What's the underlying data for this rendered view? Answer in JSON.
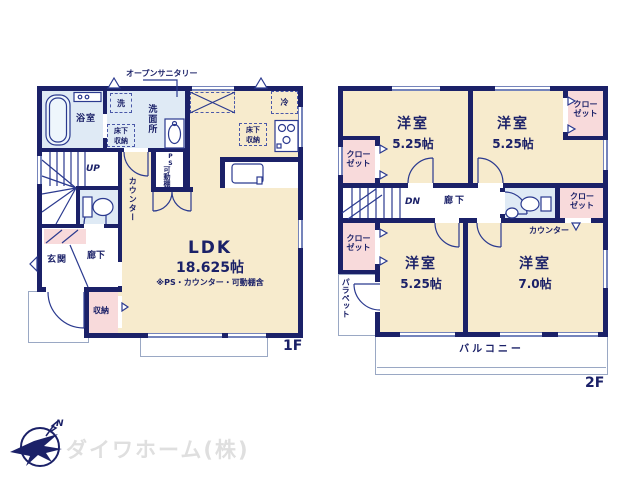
{
  "colors": {
    "wall": "#1b2168",
    "room_cream": "#f7ebcd",
    "closet_pink": "#f8dadb",
    "wet_blue": "#dfeaf5",
    "line": "#2b3a8f",
    "logo_text": "#dfdfdf"
  },
  "floor1": {
    "floor_label": "1F",
    "open_sanitary": "オープンサニタリー",
    "bath": "浴室",
    "washer": "洗",
    "washroom": "洗面所",
    "underfloor_storage_wash": "床下収納",
    "underfloor_storage_kitchen": "床下収納",
    "fridge": "冷",
    "stairs_up": "UP",
    "counter": "カウンター",
    "pipe_space": "PS",
    "movable_shelf": "可動棚",
    "entrance": "玄関",
    "hallway": "廊下",
    "storage": "収納",
    "ldk_name": "LDK",
    "ldk_size": "18.625帖",
    "ldk_note": "※PS・カウンター・可動棚含"
  },
  "floor2": {
    "floor_label": "2F",
    "bedrooms": [
      {
        "name": "洋室",
        "size": "5.25帖"
      },
      {
        "name": "洋室",
        "size": "5.25帖"
      },
      {
        "name": "洋室",
        "size": "5.25帖"
      },
      {
        "name": "洋室",
        "size": "7.0帖"
      }
    ],
    "closet": "クローゼット",
    "stairs_down": "DN",
    "hallway": "廊下",
    "counter": "カウンター",
    "parapet": "パラペット",
    "balcony": "バルコニー"
  },
  "footer": {
    "company": "ダイワホーム(株)",
    "logo_north": "N"
  }
}
